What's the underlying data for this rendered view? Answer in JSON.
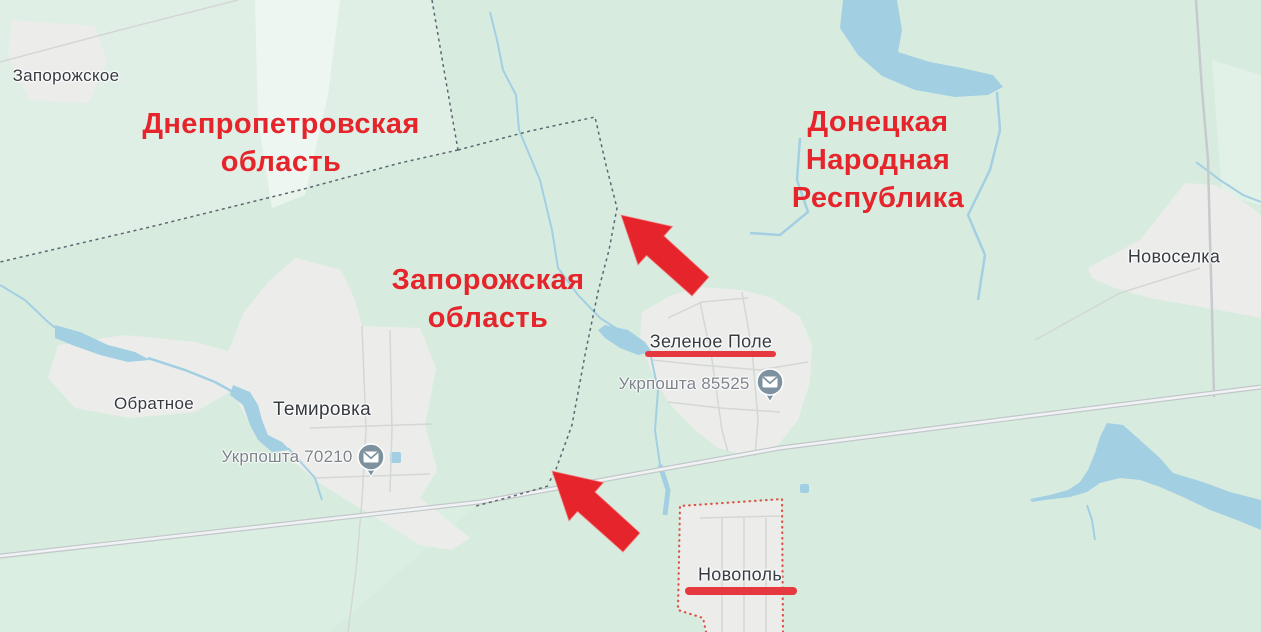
{
  "colors": {
    "background": "#d7ecdf",
    "background_light": "#e6f1e8",
    "water": "#a3cfe3",
    "urban": "#ecedeb",
    "road_casing": "#c2c7ca",
    "road_fill": "#f1f2f3",
    "road_minor": "#d3d7d6",
    "boundary_dash": "#5c6670",
    "annotation_red": "#e5252b",
    "underline_red": "#e6393f",
    "selected_boundary": "#dc5447",
    "place_label": "#363b42",
    "poi_label": "#7e838b",
    "poi_pin": "#7d929e"
  },
  "regions": [
    {
      "lines": [
        "Днепропетровская",
        "область"
      ]
    },
    {
      "lines": [
        "Донецкая",
        "Народная",
        "Республика"
      ]
    },
    {
      "lines": [
        "Запорожская",
        "область"
      ]
    }
  ],
  "places": [
    {
      "name": "Запорожское"
    },
    {
      "name": "Новоселка"
    },
    {
      "name": "Обратное"
    },
    {
      "name": "Темировка"
    },
    {
      "name": "Зеленое Поле"
    },
    {
      "name": "Новополь"
    }
  ],
  "pois": [
    {
      "label": "Укрпошта 85525",
      "icon": "envelope-pin-icon"
    },
    {
      "label": "Укрпошта 70210",
      "icon": "envelope-pin-icon"
    }
  ]
}
